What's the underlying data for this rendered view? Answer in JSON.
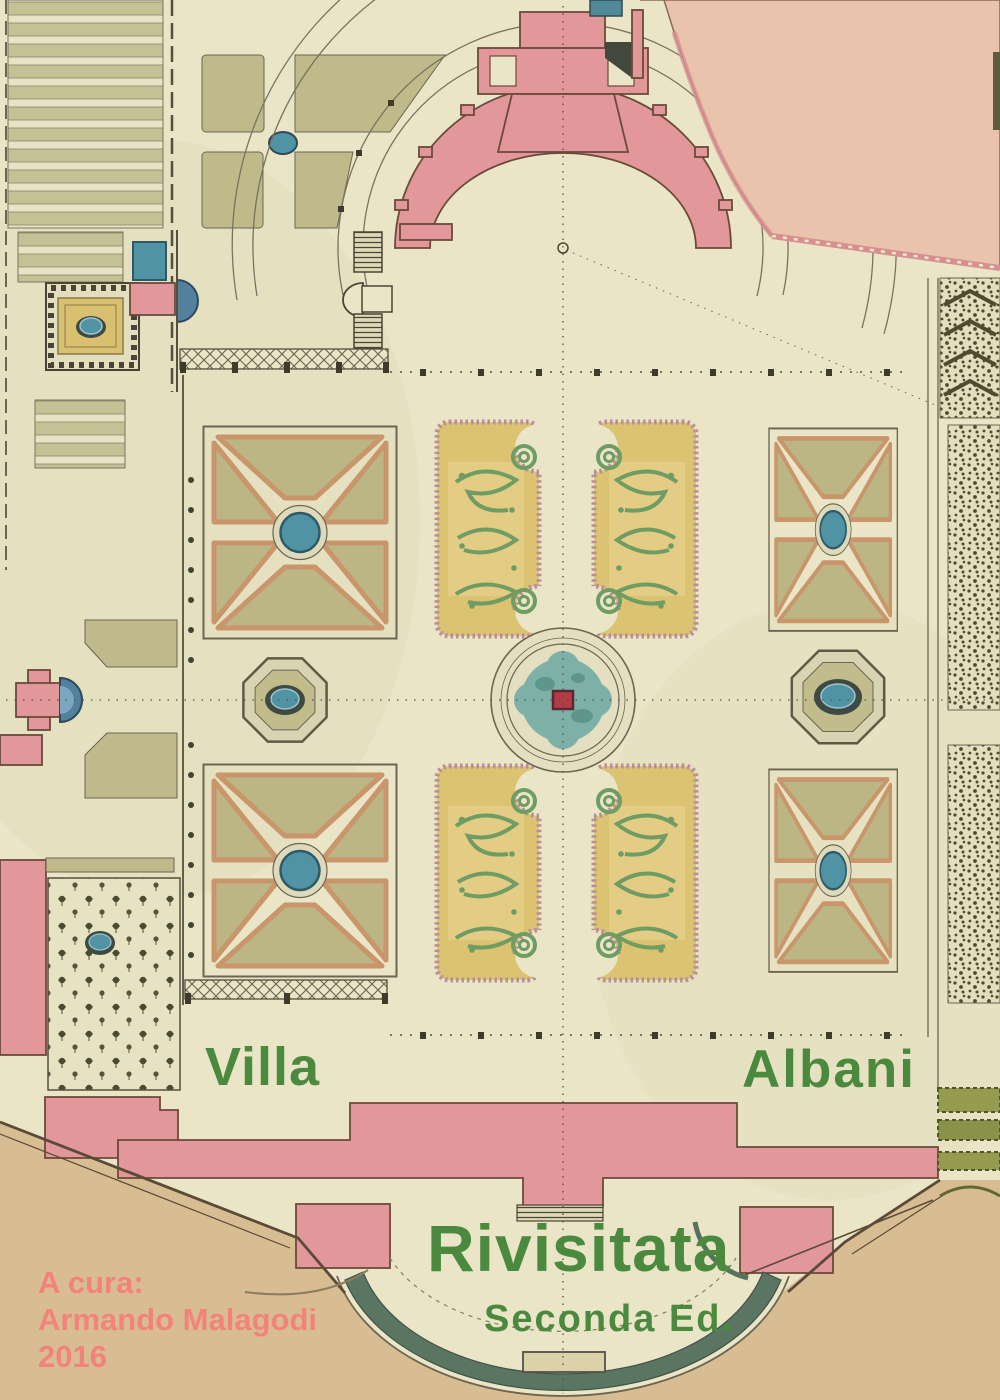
{
  "cover": {
    "title": {
      "word1": "Villa",
      "word2": "Albani"
    },
    "subtitle": "Rivisitata",
    "edition": "Seconda Ed.",
    "credits": {
      "label": "A cura:",
      "name": "Armando Malagodi",
      "year": "2016"
    }
  },
  "colors": {
    "paper": "#e9e5c6",
    "title_green": "#4b8a3e",
    "credit_red": "#f2837b",
    "building_pink": "#e2979a",
    "water_blue": "#4f93a5",
    "fountain_teal": "#7db0a7",
    "parterre_yellow": "#dcc372",
    "scroll_green": "#6f9c63",
    "lawn_olive": "#c0b989",
    "ground_tan": "#d9bd92",
    "terrace_peach": "#e9c3ab",
    "rim_green": "#5a7561",
    "ink": "#5b5340"
  }
}
